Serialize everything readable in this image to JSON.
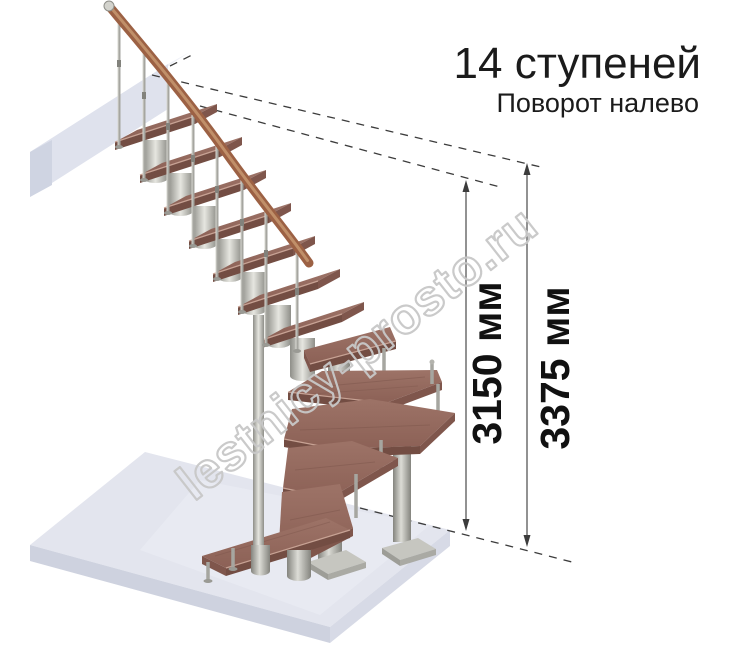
{
  "page": {
    "title": "14 ступеней",
    "subtitle": "Поворот налево"
  },
  "watermark": "lestnicy-prosto.ru",
  "dimensions": {
    "stair_height": "3150 мм",
    "total_height": "3375 мм"
  },
  "colors": {
    "tread_top": "#956b60",
    "tread_front": "#734d43",
    "tread_edge_highlight": "#c7a294",
    "handrail": "#9c6144",
    "metal": "#b7b7b1",
    "floor_slab": "#e4e6ef",
    "landing_slab": "#e9ebf3",
    "dimension_line": "#4a4a4a",
    "dashed_line": "#3c3c3c",
    "title_text": "#1b1b1b",
    "watermark_outline": "#c8c8c8"
  }
}
